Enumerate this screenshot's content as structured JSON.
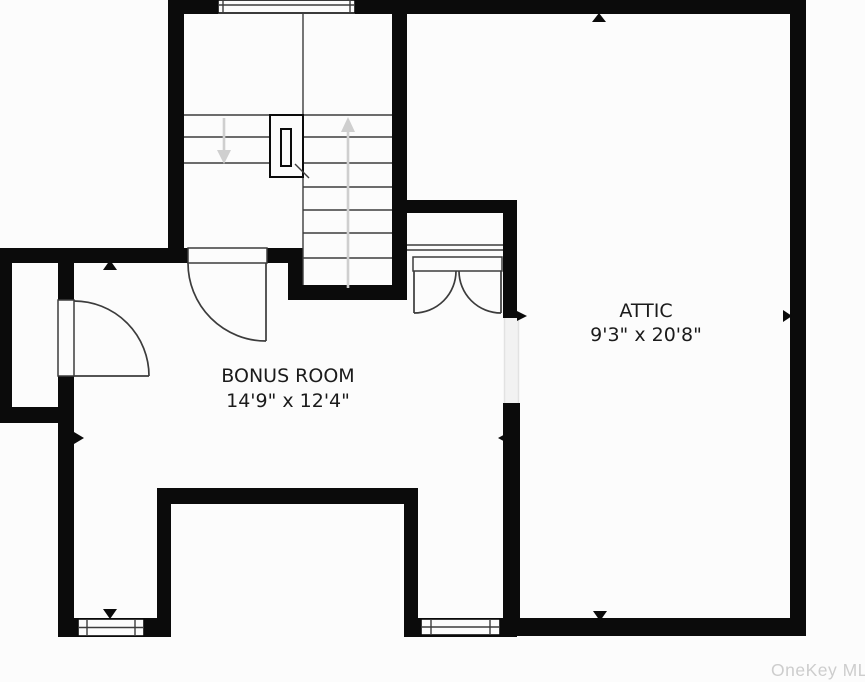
{
  "colors": {
    "bg": "#fcfcfc",
    "wall": "#0b0b0b",
    "line": "#3c3c3c",
    "stair_arrow": "#cfcfcf",
    "text": "#1b1b1b",
    "watermark": "#cdcdcd"
  },
  "rooms": [
    {
      "name": "BONUS ROOM",
      "dimensions": "14'9\" x 12'4\""
    },
    {
      "name": "ATTIC",
      "dimensions": "9'3\" x 20'8\""
    }
  ],
  "watermark": "OneKey MLS",
  "icons": {
    "stair_up_arrow": "arrow pointing up along ascending flight",
    "stair_down_arrow": "arrow pointing down along descending flight",
    "dimension_pointer": "small black triangle wall pointer"
  }
}
